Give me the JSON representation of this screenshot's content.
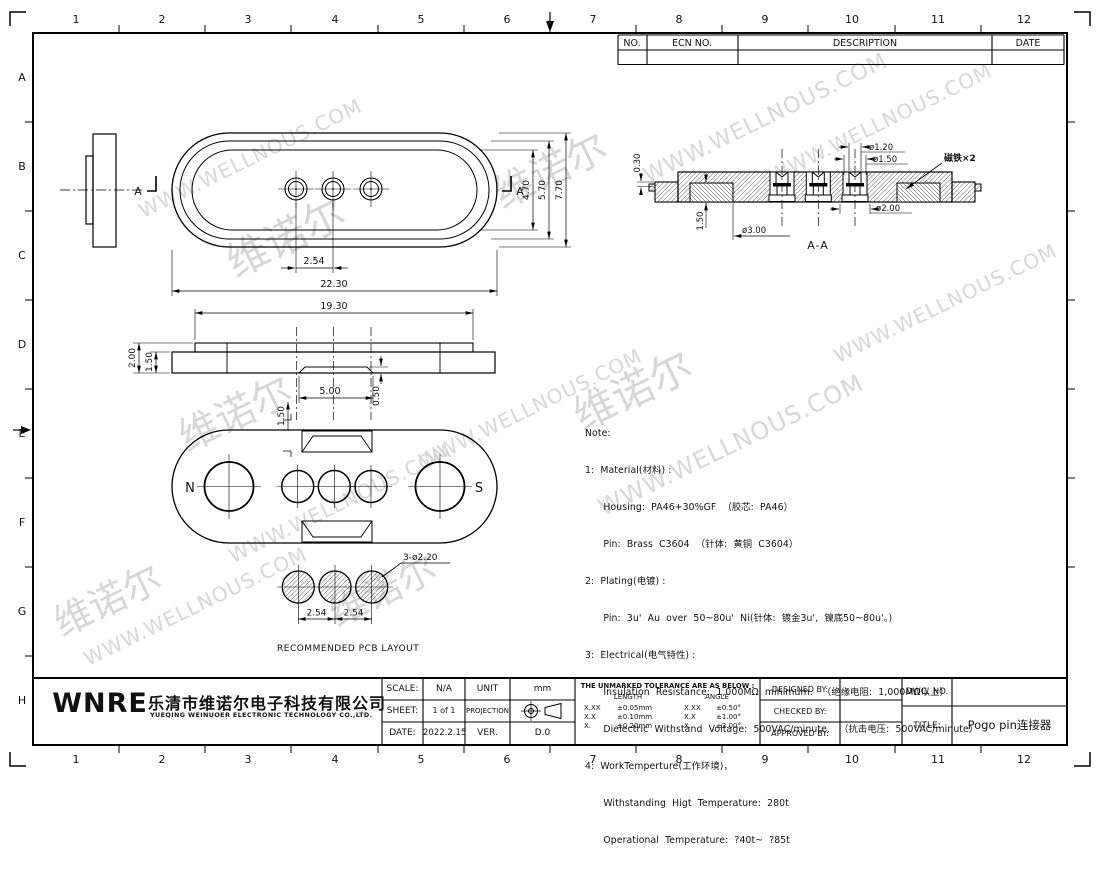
{
  "watermark": {
    "cn": "维诺尔",
    "url": "WWW.WELLNOUS.COM"
  },
  "border": {
    "columns": [
      "1",
      "2",
      "3",
      "4",
      "5",
      "6",
      "7",
      "8",
      "9",
      "10",
      "11",
      "12"
    ],
    "rows": [
      "A",
      "B",
      "C",
      "D",
      "E",
      "F",
      "G",
      "H"
    ]
  },
  "revision_table": {
    "no": "NO.",
    "ecn": "ECN  NO.",
    "description": "DESCRIPTION",
    "date": "DATE"
  },
  "views": {
    "top": {
      "pitch": "2.54",
      "overall": "22.30",
      "h_inner": "4.70",
      "h_mid": "5.70",
      "h_outer": "7.70",
      "section_left": "A",
      "section_right": "A"
    },
    "front": {
      "width": "19.30",
      "height_total": "2.00",
      "height_body": "1.50",
      "notch_width": "5.00",
      "notch_depth": "0.50",
      "notch_offset": "1.50"
    },
    "bottom": {
      "pole_left": "N",
      "pole_right": "S"
    },
    "pcb": {
      "holes": "3-ø2.20",
      "pitch1": "2.54",
      "pitch2": "2.54",
      "caption": "RECOMMENDED  PCB  LAYOUT"
    },
    "section": {
      "caption": "A-A",
      "dia_tip": "ø1.20",
      "dia_pin": "ø1.50",
      "dia_foot": "ø2.00",
      "dia_magnet": "ø3.00",
      "depth": "1.50",
      "step": "0.30",
      "magnet_label": "磁铁×2"
    }
  },
  "notes": {
    "lines": [
      "Note:",
      "1:  Material(材料) :",
      "      Housing:  PA46+30%GF  （胶芯:  PA46）",
      "      Pin:  Brass  C3604  （针体:  黄铜  C3604）",
      "2:  Plating(电镀) :",
      "      Pin:  3u'  Au  over  50~80u'  Ni(针体:  镀金3u',  镍底50~80u'。)",
      "3:  Electrical(电气特性) :",
      "      Insulation  Resistance:  1,000MΩ  minimum.   （绝缘电阻:  1,000MΩ以上）",
      "      Dielectric  Withstand  Voltage:  500VAC/minute.   （抗击电压:  500VAC/minute）",
      "4:  WorkTemperture(工作环境)，",
      "      Withstanding  Higt  Temperature:  280t",
      "      Operational  Temperature:  ?40t~  ?85t"
    ]
  },
  "title_block": {
    "logo": "WNRE",
    "company_cn": "乐清市维诺尔电子科技有限公司",
    "company_en": "YUEQING WEINUOER ELECTRONIC TECHNOLOGY CO.,LTD.",
    "scale_label": "SCALE:",
    "scale_value": "N/A",
    "unit_label": "UNIT",
    "unit_value": "mm",
    "sheet_label": "SHEET:",
    "sheet_value": "1  of  1",
    "projection_label": "PROJECTION",
    "date_label": "DATE:",
    "date_value": "2022.2.15",
    "ver_label": "VER.",
    "ver_value": "D.0",
    "tolerance": {
      "title": "THE  UNMARKED  TOLERANCE  ARE  AS  BELOW :",
      "length_label": "LENGTH",
      "angle_label": "ANGLE",
      "rows": [
        {
          "l1": "X.XX",
          "l2": "±0.05mm",
          "a1": "X.XX",
          "a2": "±0.50°"
        },
        {
          "l1": "X.X",
          "l2": "±0.10mm",
          "a1": "X.X",
          "a2": "±1.00°"
        },
        {
          "l1": "X.",
          "l2": "±0.20mm",
          "a1": "X.",
          "a2": "±2.00°"
        }
      ]
    },
    "designed_label": "DESIGNED  BY:",
    "checked_label": "CHECKED  BY:",
    "approved_label": "APPROVED  BY:",
    "dwg_label": "DWG.  NO.",
    "title_label": "TITLE:",
    "title_value": "Pogo  pin连接器"
  }
}
